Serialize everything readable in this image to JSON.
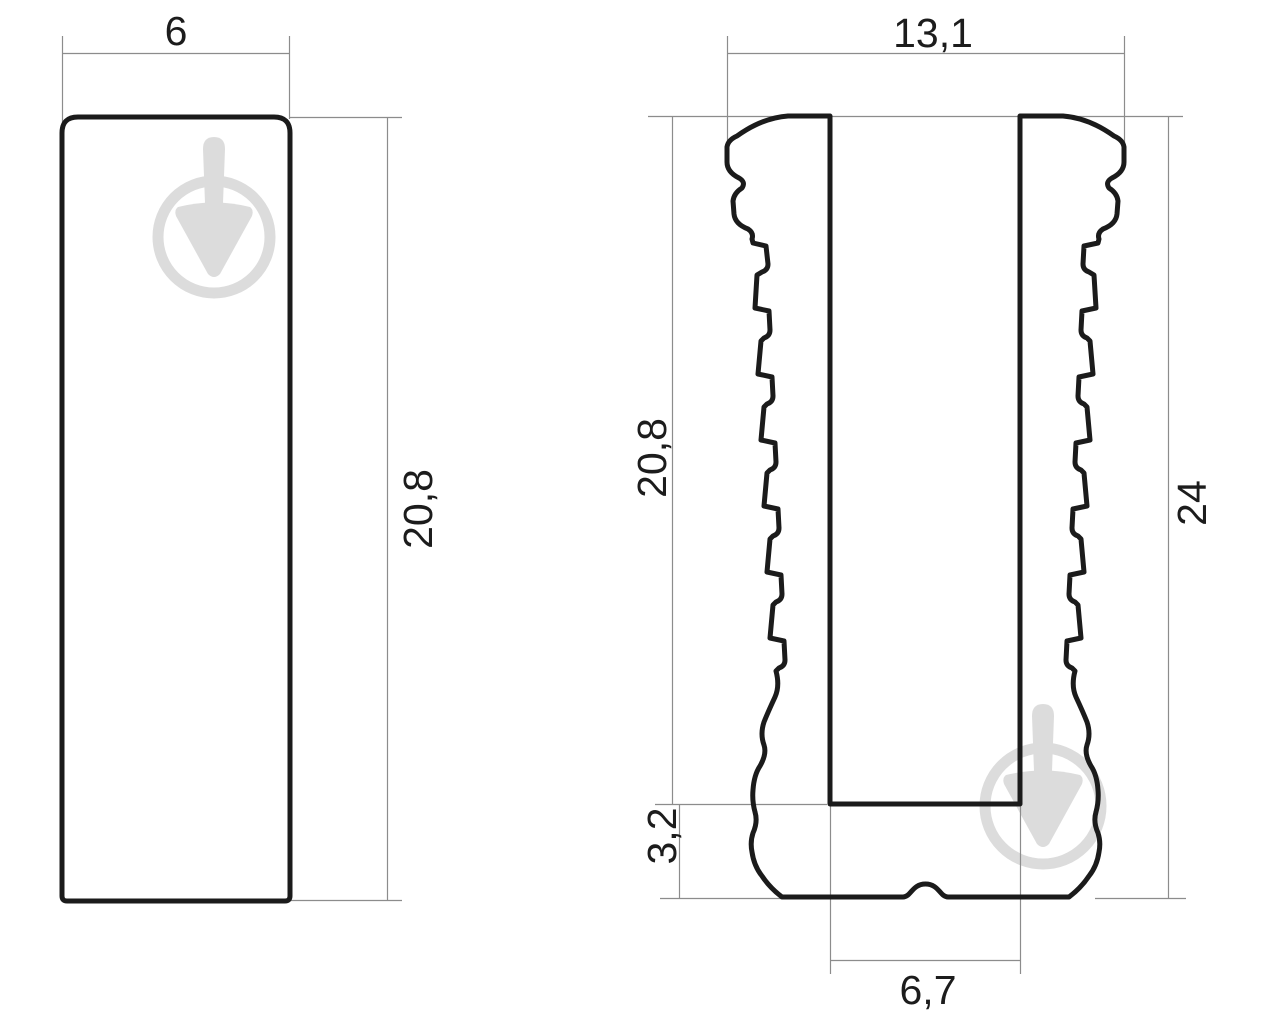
{
  "drawing": {
    "type": "technical-dimension-drawing",
    "views": 2,
    "colors": {
      "background": "#ffffff",
      "outline": "#1b1b1b",
      "dimension_lines": "#8c8c8c",
      "watermark": "#dcdcdc"
    },
    "left_view": {
      "description": "flat-bar-cross-section",
      "width": "6",
      "height": "20,8"
    },
    "right_view": {
      "description": "ribbed-sleeve-cross-section",
      "top_width": "13,1",
      "slot_depth": "20,8",
      "total_height": "24",
      "base_thickness": "3,2",
      "slot_width": "6,7"
    },
    "watermark": {
      "icon": "trowel-in-circle",
      "count": 2
    }
  }
}
